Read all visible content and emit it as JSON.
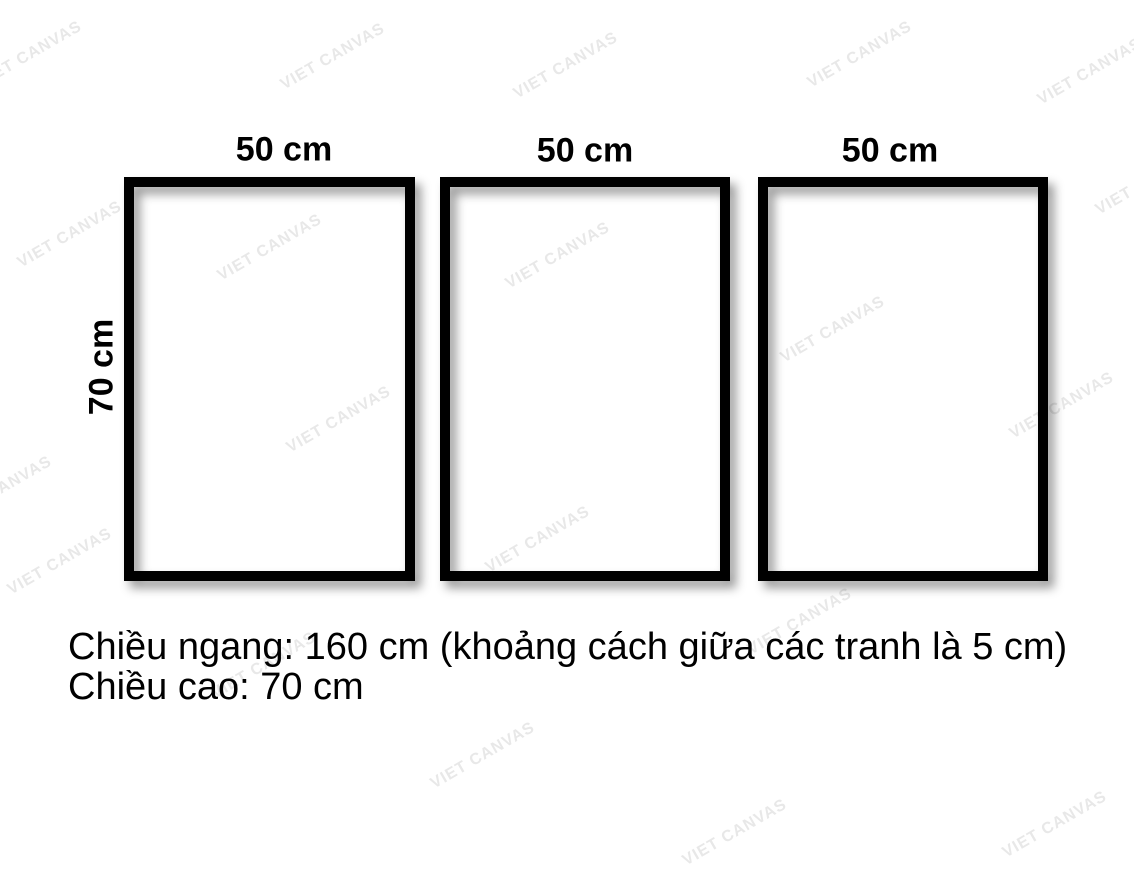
{
  "watermark": {
    "text": "VIET CANVAS"
  },
  "frames": [
    {
      "width_label": "50 cm"
    },
    {
      "width_label": "50 cm"
    },
    {
      "width_label": "50 cm"
    }
  ],
  "height_label": "70 cm",
  "caption": {
    "line1": "Chiều ngang: 160 cm (khoảng cách giữa các tranh là 5 cm)",
    "line2": "Chiều cao: 70 cm"
  },
  "colors": {
    "background": "#ffffff",
    "frame_border": "#000000",
    "text": "#000000",
    "watermark": "#e8e8e8"
  }
}
